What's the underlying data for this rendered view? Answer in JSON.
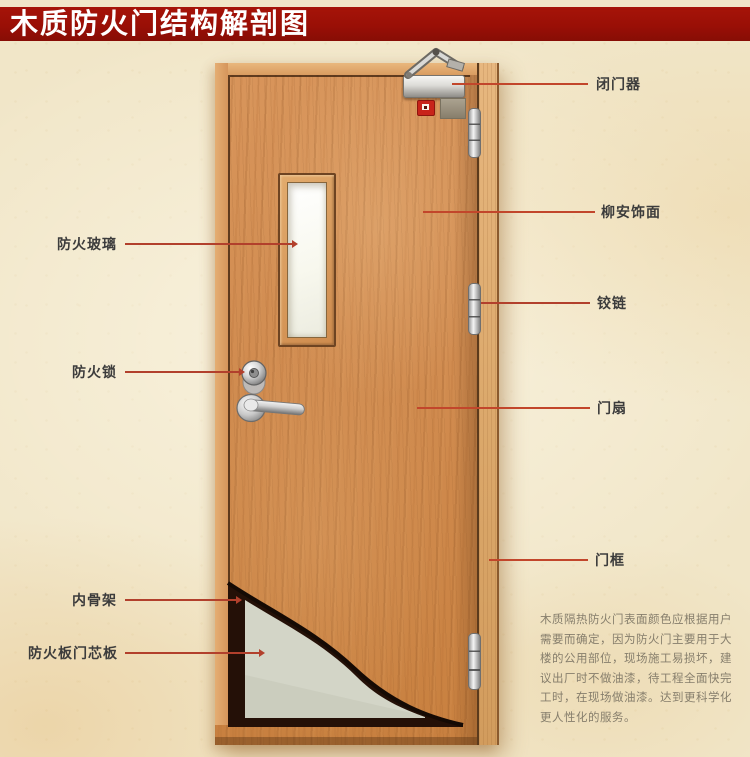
{
  "title": "木质防火门结构解剖图",
  "callouts": {
    "left": [
      {
        "id": "fire-glass",
        "text": "防火玻璃"
      },
      {
        "id": "fire-lock",
        "text": "防火锁"
      },
      {
        "id": "inner-skeleton",
        "text": "内骨架"
      },
      {
        "id": "fire-board-core",
        "text": "防火板门芯板"
      }
    ],
    "right": [
      {
        "id": "door-closer",
        "text": "闭门器"
      },
      {
        "id": "lauan-veneer",
        "text": "柳安饰面"
      },
      {
        "id": "hinge",
        "text": "铰链"
      },
      {
        "id": "door-leaf",
        "text": "门扇"
      },
      {
        "id": "door-frame",
        "text": "门框"
      }
    ]
  },
  "description": {
    "lines": [
      "木质隔热防火门表面颜色应根据用户",
      "需要而确定，因为防火门主要用于大",
      "楼的公用部位，现场施工易损坏，建",
      "议出厂时不做油漆，待工程全面快完",
      "工时，在现场做油漆。达到更科学化",
      "更人性化的服务。"
    ]
  },
  "colors": {
    "banner_red": "#9a0f06",
    "leader_line": "#b2402c",
    "background_cream": "#f1e6c8",
    "door_wood": "#d18c50",
    "frame_wood": "#dca96c",
    "core_panel_gray": "#d3d5c7",
    "skeleton_dark": "#241007",
    "label_text": "#3c3c3c",
    "description_text": "#867e6c"
  }
}
